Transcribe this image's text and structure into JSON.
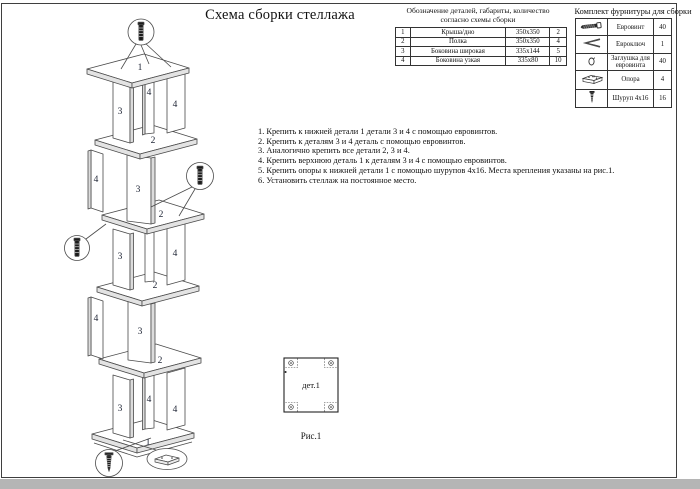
{
  "page_title": "Схема сборки стеллажа",
  "parts_table": {
    "title_line1": "Обозначение деталей, габариты, количество",
    "title_line2": "согласно схемы сборки",
    "rows": [
      {
        "num": "1",
        "name": "Крыша/дно",
        "size": "350х350",
        "qty": "2"
      },
      {
        "num": "2",
        "name": "Полка",
        "size": "350х350",
        "qty": "4"
      },
      {
        "num": "3",
        "name": "Боковина широкая",
        "size": "335х144",
        "qty": "5"
      },
      {
        "num": "4",
        "name": "Боковина узкая",
        "size": "335х80",
        "qty": "10"
      }
    ]
  },
  "hardware_table": {
    "title": "Комплект фурнитуры для сборки",
    "rows": [
      {
        "icon": "euroscrew-icon",
        "name": "Евровинт",
        "qty": "40"
      },
      {
        "icon": "hex-key-icon",
        "name": "Евроключ",
        "qty": "1"
      },
      {
        "icon": "cap-icon",
        "name": "Заглушка для евровинта",
        "qty": "40"
      },
      {
        "icon": "support-foot-icon",
        "name": "Опора",
        "qty": "4"
      },
      {
        "icon": "screw-icon",
        "name": "Шуруп 4х16",
        "qty": "16"
      }
    ]
  },
  "instructions": [
    "1. Крепить к нижней детали 1 детали 3 и 4 с помощью евровинтов.",
    "2. Крепить к деталям 3 и 4 деталь с помощью евровинтов.",
    "3. Аналогично крепить все детали 2, 3 и 4.",
    "4. Крепить верхнюю деталь 1 к деталям 3 и 4 с помощью евровинтов.",
    "5. Крепить опоры к нижней детали 1 с помощью шурупов 4х16. Места крепления указаны на рис.1.",
    "6. Установить стеллаж на постоянное место."
  ],
  "figure": {
    "part_label": "дет.1",
    "caption": "Рис.1"
  },
  "diagram": {
    "labels": [
      "1",
      "3",
      "4",
      "4",
      "2",
      "4",
      "3",
      "2",
      "3",
      "4",
      "2",
      "4",
      "3",
      "2",
      "3",
      "4",
      "4",
      "1"
    ]
  },
  "colors": {
    "line": "#4a4a4a",
    "shade": "#dcdcdc",
    "page_border": "#3f3f3f",
    "bottom_strip": "#b5b5b5"
  }
}
